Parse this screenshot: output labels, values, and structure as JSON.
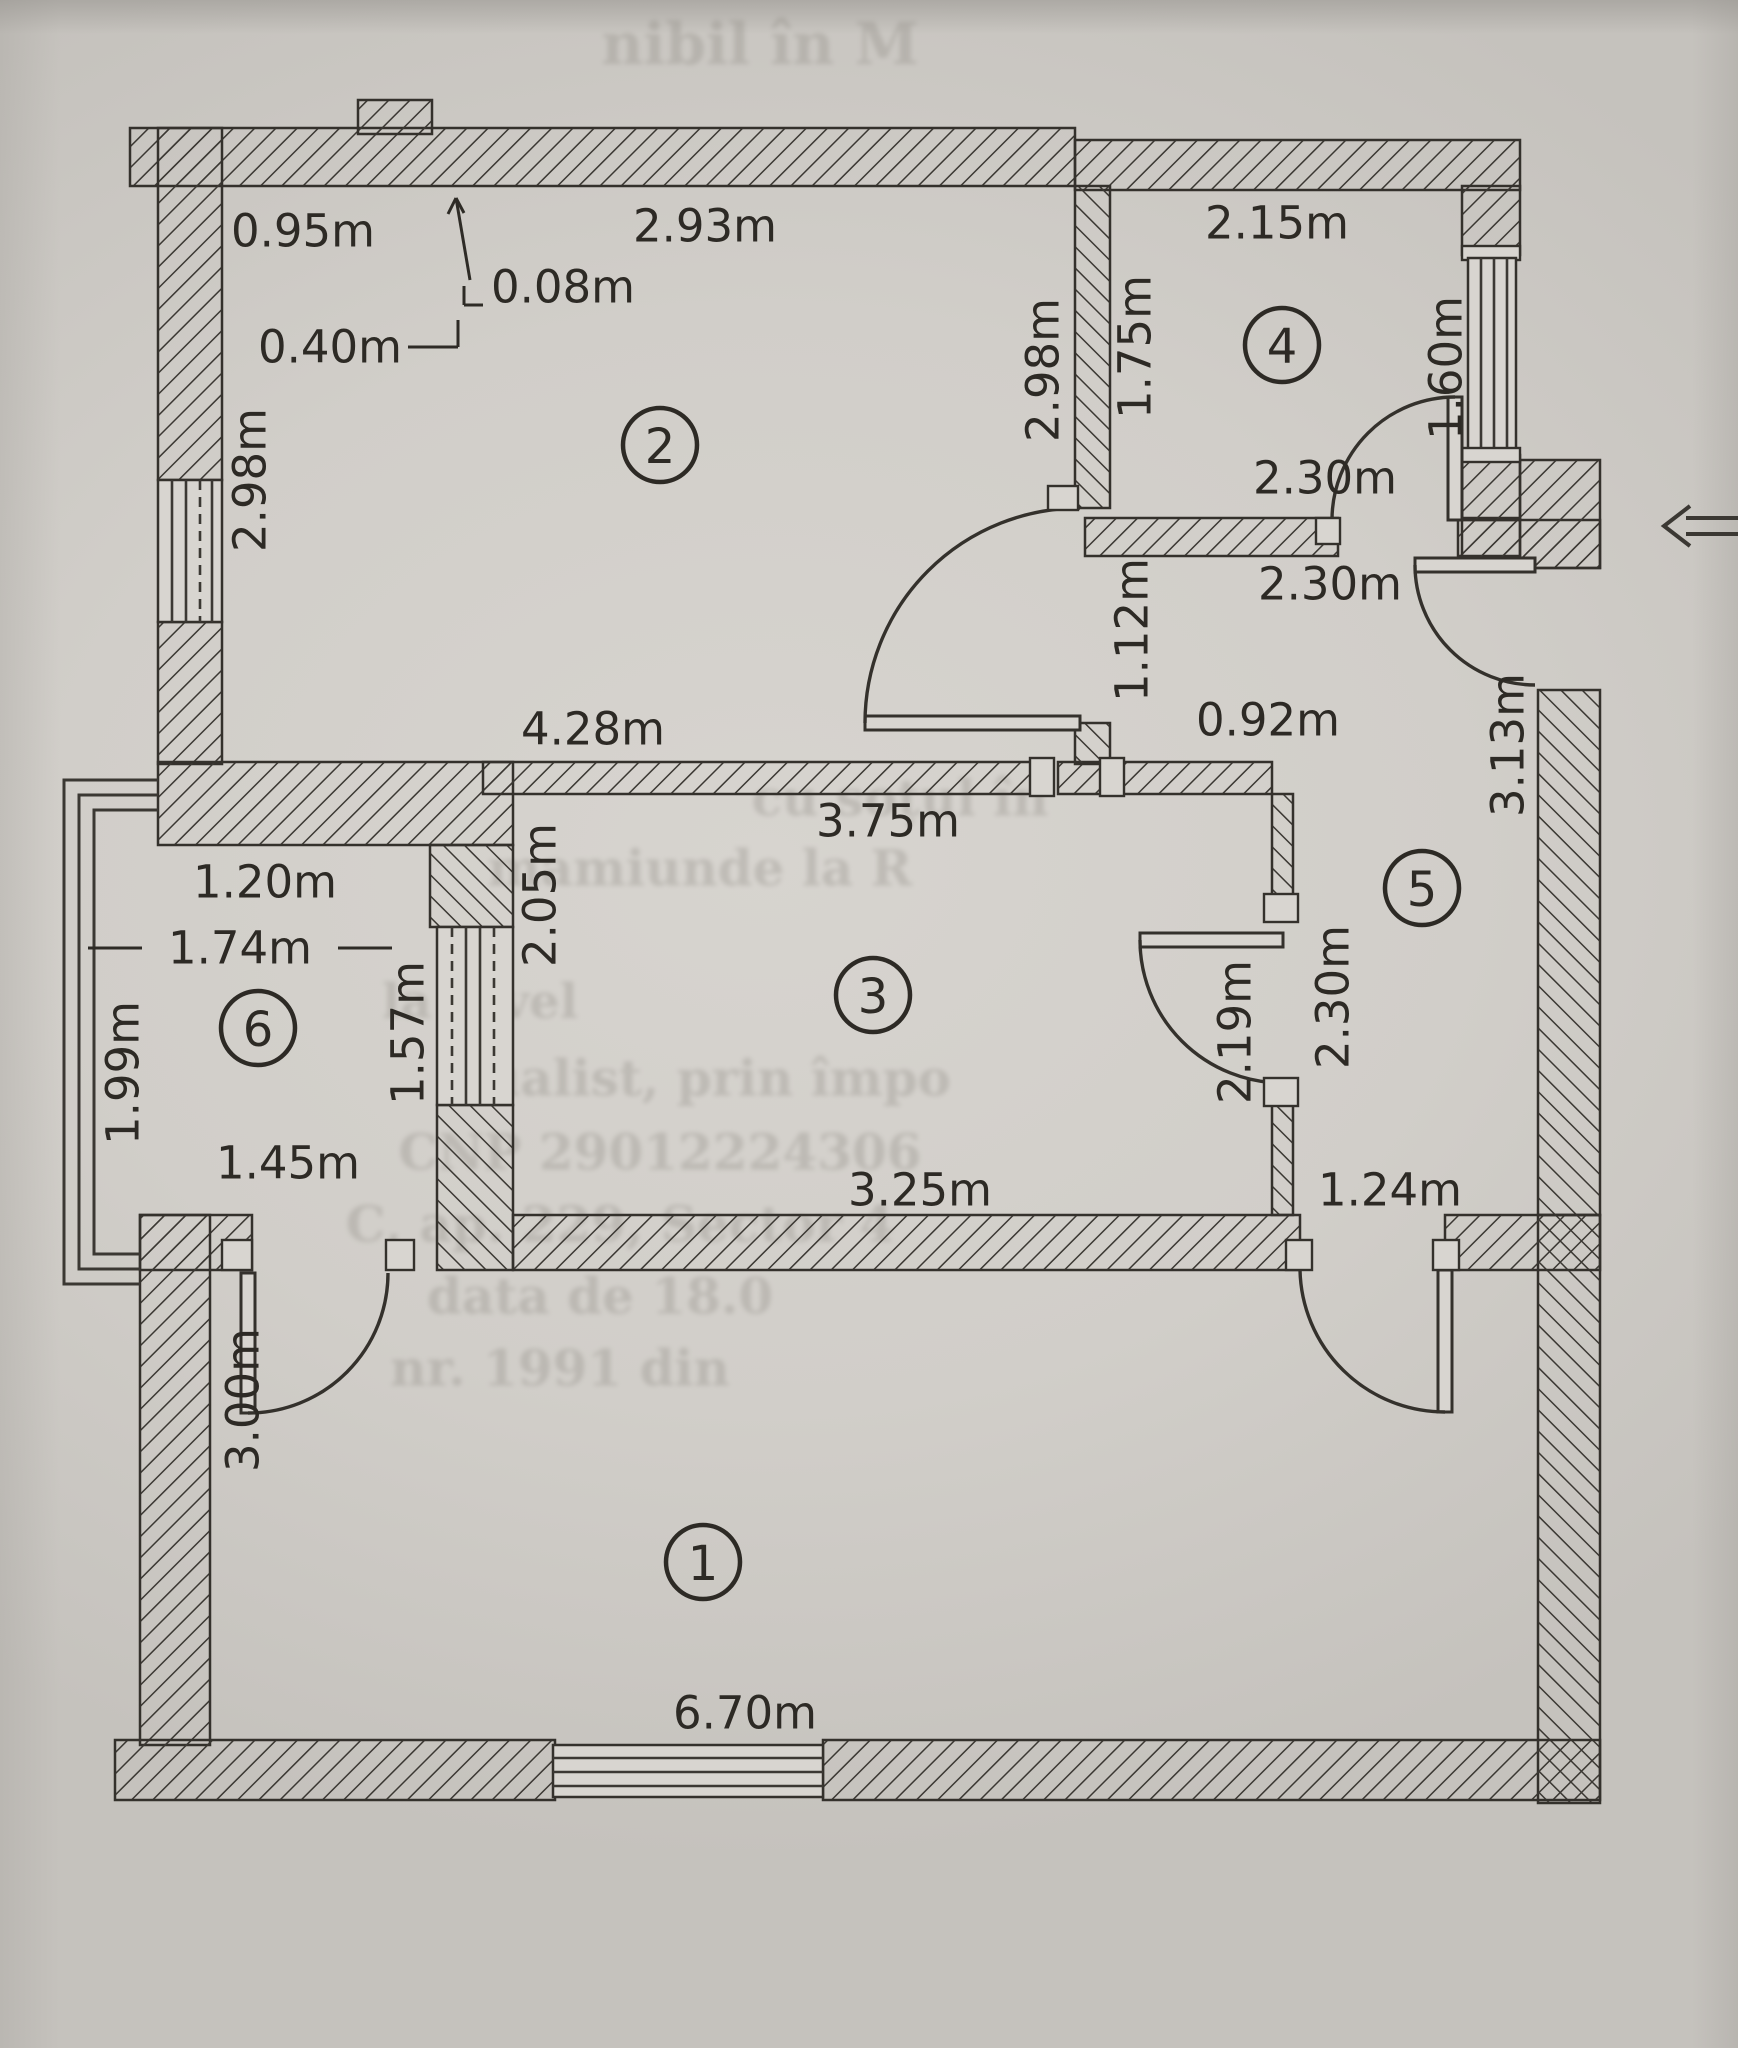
{
  "document": {
    "kind": "scanned apartment floor plan",
    "paper_color": "#d2cfca",
    "ink_color": "#34312c"
  },
  "rooms": [
    {
      "number": "1"
    },
    {
      "number": "2"
    },
    {
      "number": "3"
    },
    {
      "number": "4"
    },
    {
      "number": "5"
    },
    {
      "number": "6"
    }
  ],
  "dims": [
    {
      "name": "dim-top-left-width",
      "text": "0.95m"
    },
    {
      "name": "dim-top-left-step",
      "text": "0.40m"
    },
    {
      "name": "dim-wall-offset",
      "text": "0.08m"
    },
    {
      "name": "dim-room2-top",
      "text": "2.93m"
    },
    {
      "name": "dim-room4-top",
      "text": "2.15m"
    },
    {
      "name": "dim-room4-bottom-inner",
      "text": "2.30m"
    },
    {
      "name": "dim-room4-bottom-outer",
      "text": "2.30m"
    },
    {
      "name": "dim-room2-bottom",
      "text": "4.28m"
    },
    {
      "name": "dim-room3-top",
      "text": "3.75m"
    },
    {
      "name": "dim-hall-wall-segment",
      "text": "0.92m"
    },
    {
      "name": "dim-balcony-top",
      "text": "1.20m"
    },
    {
      "name": "dim-balcony-inner-width",
      "text": "1.74m"
    },
    {
      "name": "dim-balcony-bottom",
      "text": "1.45m"
    },
    {
      "name": "dim-room3-bottom",
      "text": "3.25m"
    },
    {
      "name": "dim-hall-bottom-segment",
      "text": "1.24m"
    },
    {
      "name": "dim-room1-bottom",
      "text": "6.70m"
    },
    {
      "name": "dim-room2-left-height",
      "text": "2.98m"
    },
    {
      "name": "dim-room2-right-height",
      "text": "2.98m"
    },
    {
      "name": "dim-room4-left-height",
      "text": "1.75m"
    },
    {
      "name": "dim-room4-window",
      "text": "1.60m"
    },
    {
      "name": "dim-hall-top-segment",
      "text": "1.12m"
    },
    {
      "name": "dim-room3-left-height",
      "text": "2.05m"
    },
    {
      "name": "dim-balcony-window",
      "text": "1.57m"
    },
    {
      "name": "dim-balcony-left-height",
      "text": "1.99m"
    },
    {
      "name": "dim-room3-door",
      "text": "2.19m"
    },
    {
      "name": "dim-room3-right-height",
      "text": "2.30m"
    },
    {
      "name": "dim-hall-right-height",
      "text": "3.13m"
    },
    {
      "name": "dim-room1-left-height",
      "text": "3.00m"
    }
  ],
  "icons": {
    "entry_arrow": "double-arrow-left"
  },
  "bleedthrough": [
    {
      "text": "nibil în M"
    },
    {
      "text": "cu soțul în"
    },
    {
      "text": "mamiunde la R"
    },
    {
      "text": "la nivel"
    },
    {
      "text": "dualist, prin împo"
    },
    {
      "text": "CNP 29012224306"
    },
    {
      "text": "C, ap. 229, Sector 4"
    },
    {
      "text": "data de 18.0"
    },
    {
      "text": "nr. 1991 din"
    }
  ]
}
